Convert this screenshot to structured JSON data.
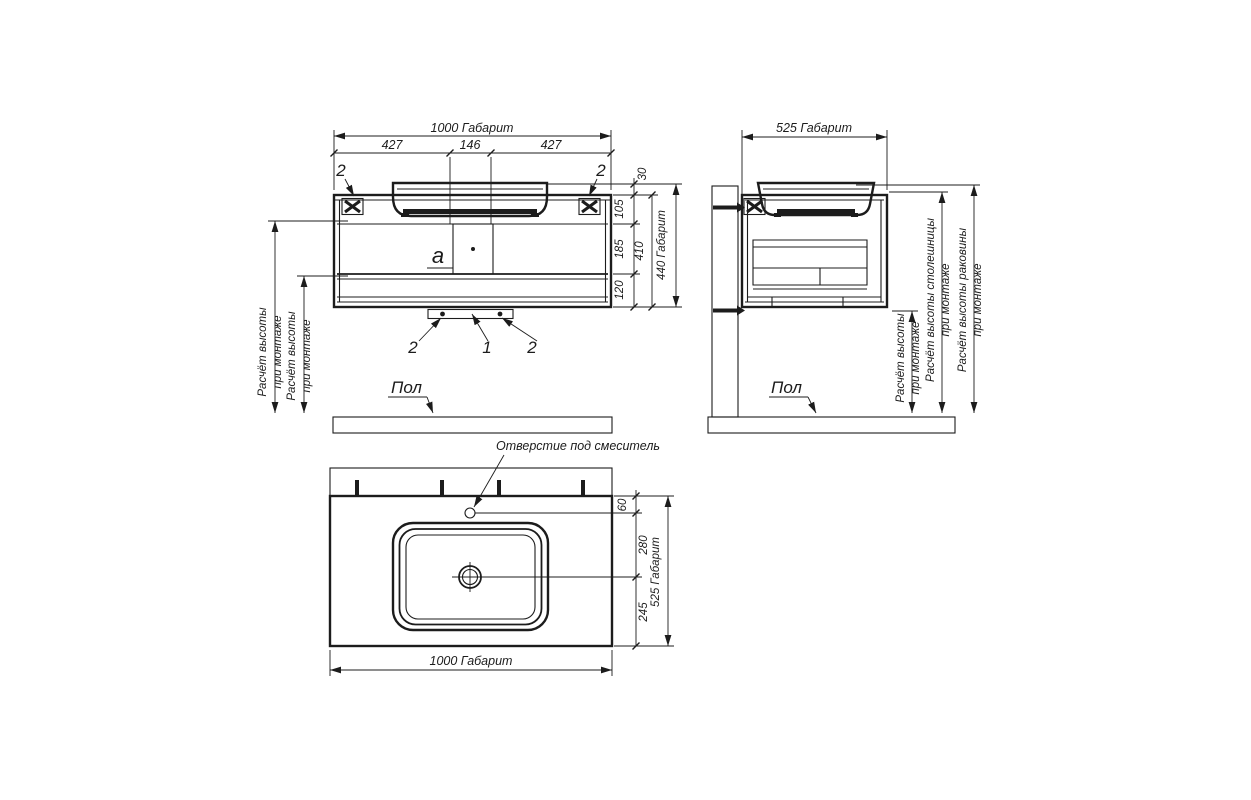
{
  "front": {
    "dims": {
      "total_width": "1000 Габарит",
      "left": "427",
      "center": "146",
      "right": "427",
      "sink_lip": "30",
      "upper": "105",
      "middle": "185",
      "lower": "120",
      "body": "410",
      "total_height": "440 Габарит"
    },
    "callouts": {
      "bracket_left": "2",
      "bracket_right": "2",
      "panel": "а",
      "leg_left": "2",
      "siphon": "1",
      "leg_right": "2"
    },
    "mount_note_1": [
      "Расчёт высоты",
      "при монтаже"
    ],
    "mount_note_2": [
      "Расчёт высоты",
      "при монтаже"
    ],
    "floor": "Пол"
  },
  "side": {
    "dims": {
      "total_depth": "525 Габарит"
    },
    "mount_note": [
      "Расчёт высоты",
      "при монтаже"
    ],
    "countertop_note": [
      "Расчёт высоты столешницы",
      "при монтаже"
    ],
    "sink_note": [
      "Расчёт высоты раковины",
      "при монтаже"
    ],
    "floor": "Пол"
  },
  "plan": {
    "callout_faucet": "Отверстие под смеситель",
    "dims": {
      "faucet_offset": "60",
      "faucet_to_drain": "280",
      "drain_to_edge": "245",
      "total_depth": "525 Габарит",
      "total_width": "1000 Габарит"
    }
  }
}
